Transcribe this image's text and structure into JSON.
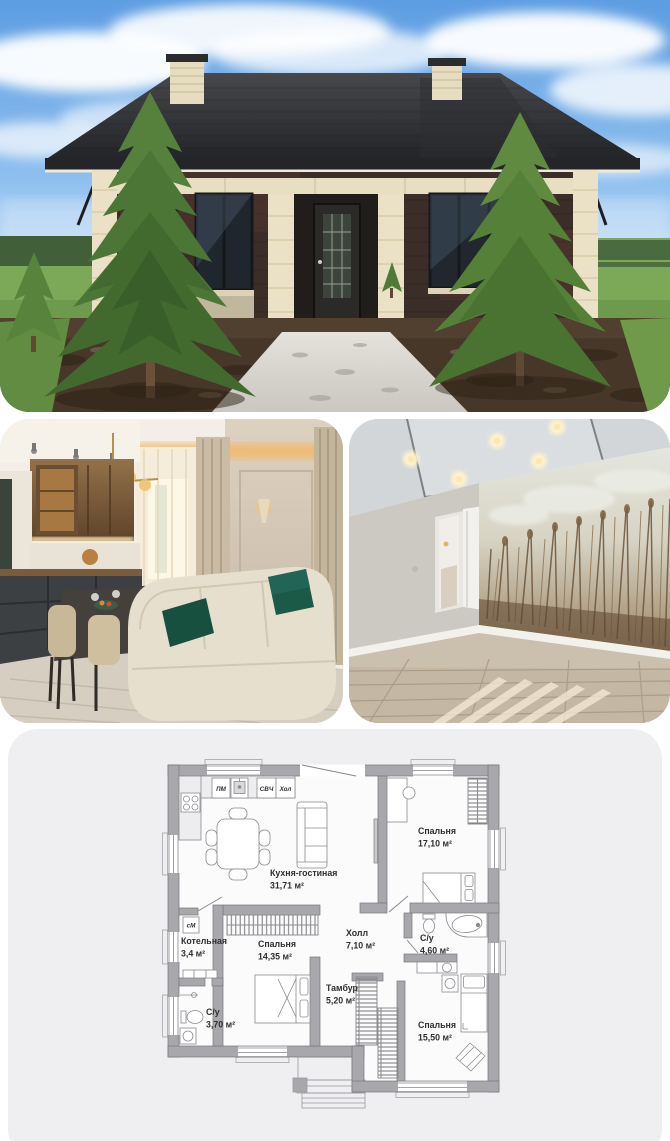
{
  "floor_plan": {
    "rooms": [
      {
        "name": "Кухня-гостиная",
        "area": "31,71 м²"
      },
      {
        "name": "Спальня",
        "area": "17,10 м²"
      },
      {
        "name": "Холл",
        "area": "7,10 м²"
      },
      {
        "name": "С/у",
        "area": "4,60 м²"
      },
      {
        "name": "Спальня",
        "area": "15,50 м²"
      },
      {
        "name": "Тамбур",
        "area": "5,20 м²"
      },
      {
        "name": "Спальня",
        "area": "14,35 м²"
      },
      {
        "name": "Котельная",
        "area": "3,4 м²"
      },
      {
        "name": "С/у",
        "area": "3,70 м²"
      }
    ],
    "appliances": [
      {
        "label": "ПМ"
      },
      {
        "label": "СВЧ"
      },
      {
        "label": "Хол"
      },
      {
        "label": "сМ"
      }
    ],
    "colors": {
      "card_background": "#efeff1",
      "walls": "#a8a8ac",
      "plan_lines": "#808085",
      "label_text": "#2f2f31",
      "page_background": "#ffffff"
    }
  }
}
